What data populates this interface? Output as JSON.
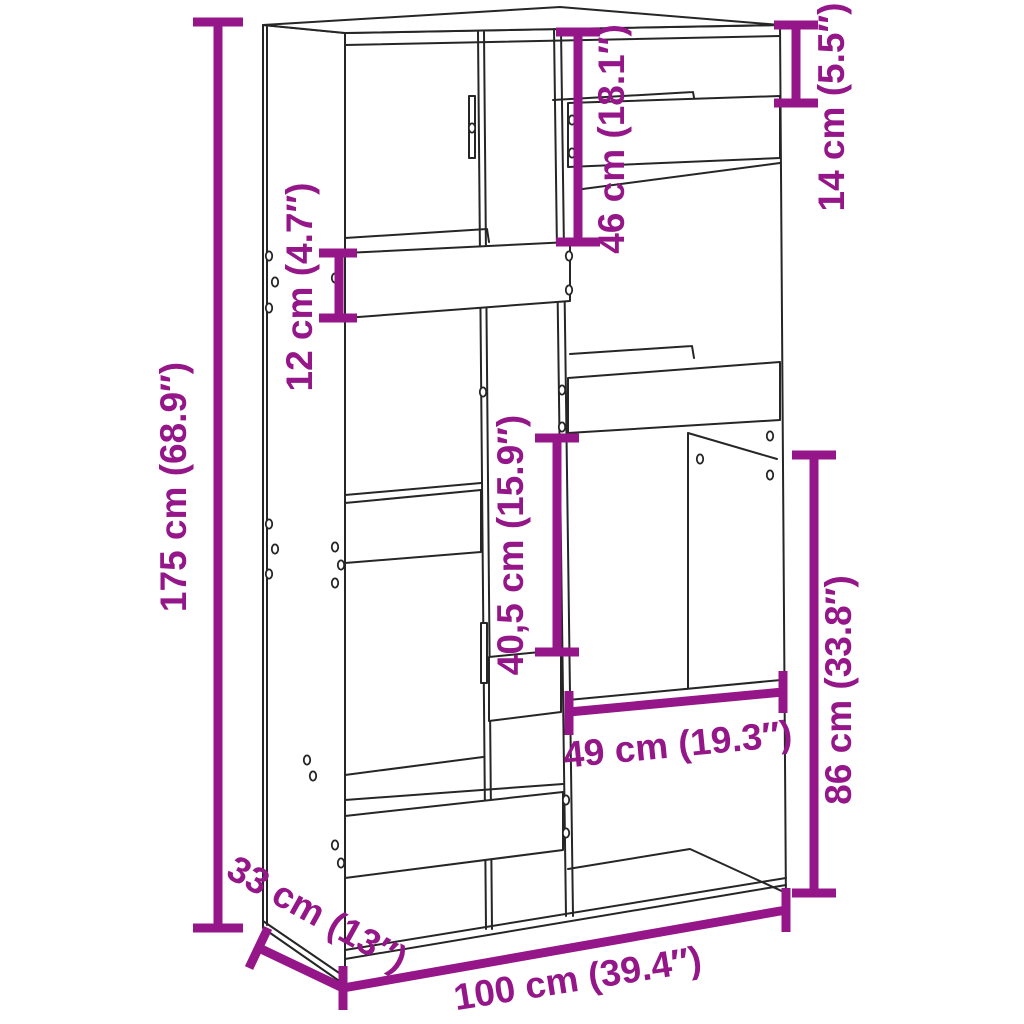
{
  "figure": {
    "kind": "furniture-dimension-diagram",
    "subject": "bookcase-room-divider"
  },
  "colors": {
    "accent": "#951689",
    "line": "#262626",
    "background": "#ffffff"
  },
  "annotations": {
    "overall_height": "175 cm (68.9″)",
    "left_opening_height": "12 cm (4.7″)",
    "upper_opening_height": "46 cm (18.1″)",
    "top_right_opening_height": "14 cm (5.5″)",
    "middle_opening_height": "40,5 cm (15.9″)",
    "lower_right_section_height": "86 cm (33.8″)",
    "right_opening_width": "49 cm (19.3″)",
    "depth": "33 cm (13″)",
    "overall_width": "100 cm (39.4″)"
  }
}
